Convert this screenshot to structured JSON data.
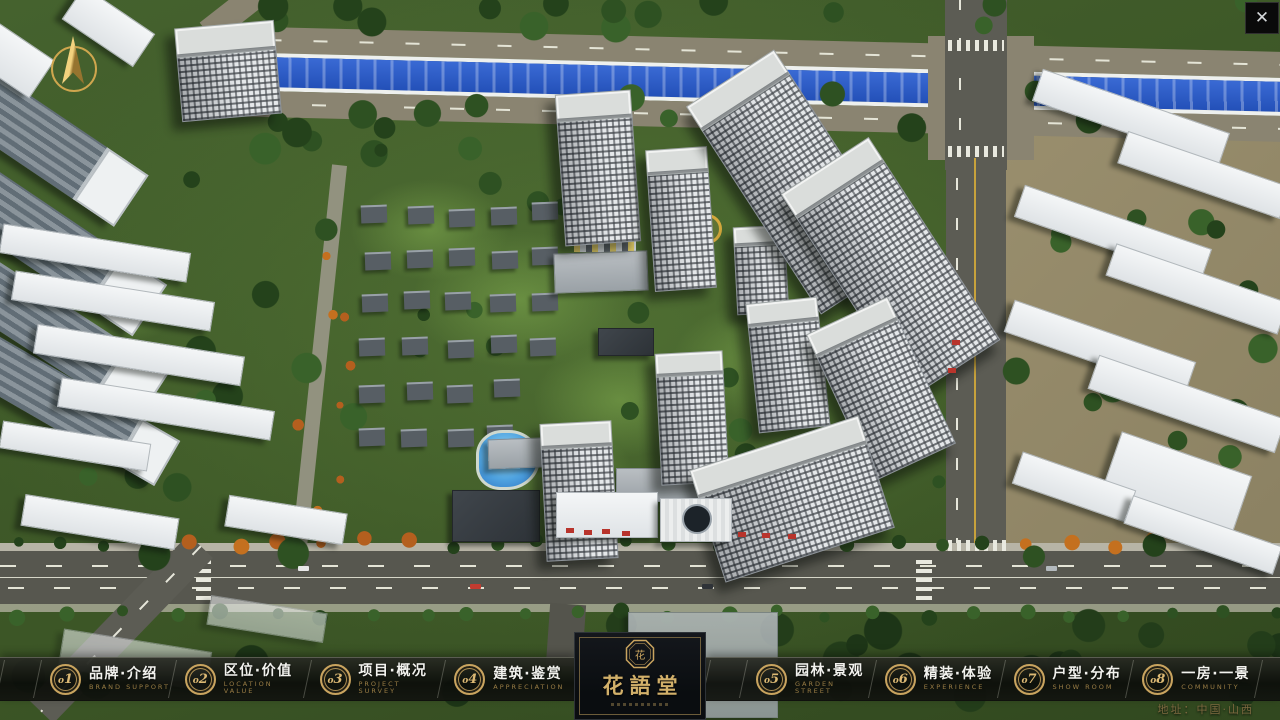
{
  "window": {
    "close_glyph": "✕"
  },
  "logo": {
    "title": "花語堂",
    "seal_text": "花"
  },
  "nav": {
    "items": [
      {
        "num": "o1",
        "label": "品牌·介绍",
        "sublabel": "BRAND SUPPORT"
      },
      {
        "num": "o2",
        "label": "区位·价值",
        "sublabel": "LOCATION VALUE"
      },
      {
        "num": "o3",
        "label": "项目·概况",
        "sublabel": "PROJECT SURVEY"
      },
      {
        "num": "o4",
        "label": "建筑·鉴赏",
        "sublabel": "APPRECIATION"
      },
      {
        "num": "o5",
        "label": "园林·景观",
        "sublabel": "GARDEN STREET"
      },
      {
        "num": "o6",
        "label": "精装·体验",
        "sublabel": "EXPERIENCE"
      },
      {
        "num": "o7",
        "label": "户型·分布",
        "sublabel": "SHOW ROOM"
      },
      {
        "num": "o8",
        "label": "一房·一景",
        "sublabel": "COMMUNITY"
      }
    ]
  },
  "footer": {
    "address": "地址：中国·山西"
  },
  "colors": {
    "accent_gold": "#c9a45f",
    "gold_dim": "#8d7748",
    "bar_bg": "#121410",
    "panel_bg": "#0d1014",
    "river_blue": "#2b57c4",
    "road_grey": "#59594f",
    "ground_green": "#45622e",
    "label_white": "#f2f2ee"
  }
}
